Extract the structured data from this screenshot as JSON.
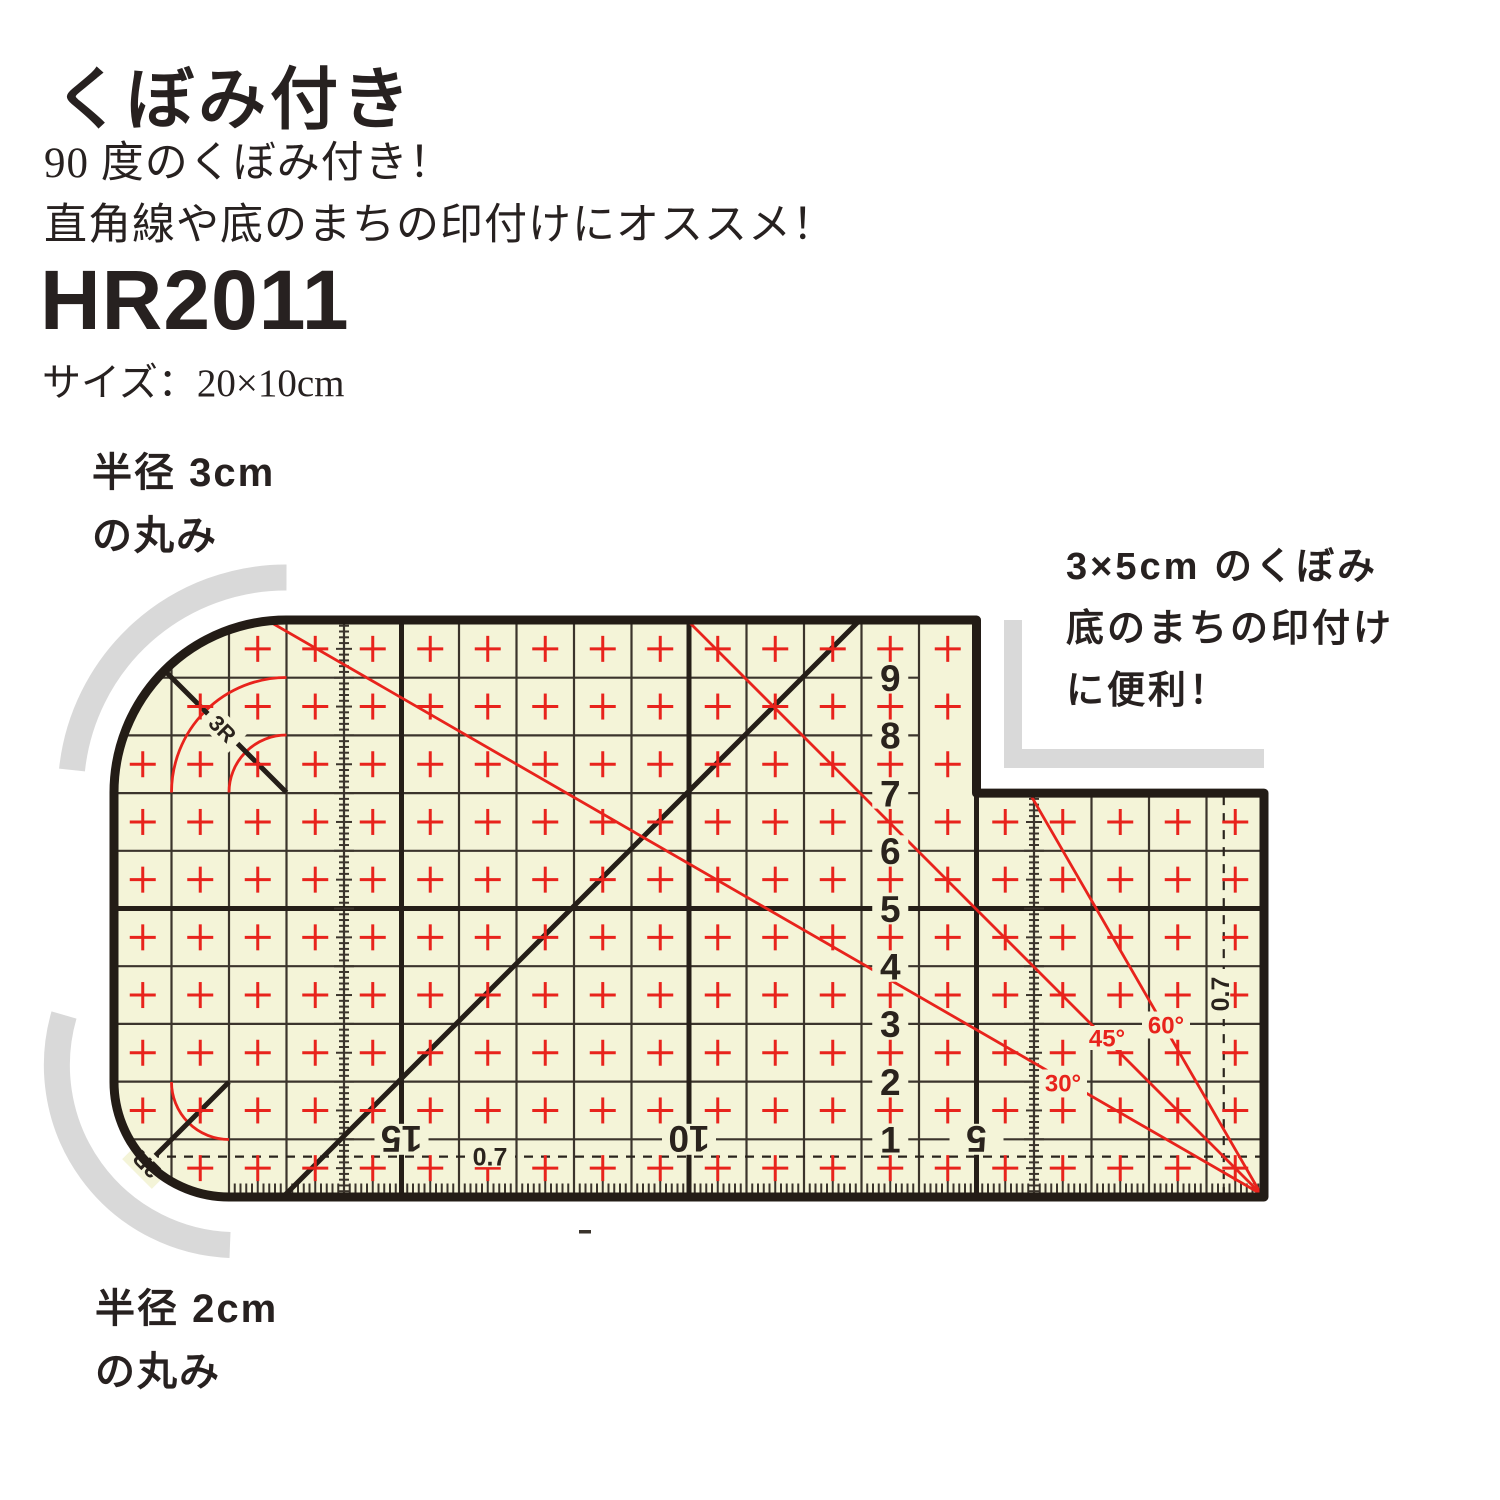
{
  "header": {
    "title": "くぼみ付き",
    "subtitle1": "90 度のくぼみ付き！",
    "subtitle2": "直角線や底のまちの印付けにオススメ！",
    "model": "HR2011",
    "size_label": "サイズ：20×10cm"
  },
  "callouts": {
    "top_left_line1": "半径 3cm",
    "top_left_line2": "の丸み",
    "bottom_left_line1": "半径 2cm",
    "bottom_left_line2": "の丸み",
    "right_line1": "3×5cm のくぼみ",
    "right_line2": "底のまちの印付け",
    "right_line3": "に便利！"
  },
  "ruler": {
    "width_cm": 20,
    "height_cm": 10,
    "notch": {
      "width_cm": 5,
      "depth_cm": 3
    },
    "corner_radius_top_left_cm": 3,
    "corner_radius_bottom_left_cm": 2,
    "side_numbers": [
      "9",
      "8",
      "7",
      "6",
      "5",
      "4",
      "3",
      "2",
      "1"
    ],
    "bottom_numbers": [
      "15",
      "10",
      "5"
    ],
    "angle_labels": [
      "30°",
      "45°",
      "60°"
    ],
    "offset_label_bottom": "0.7",
    "offset_label_right": "0.7",
    "radius_label_top_left": "3R",
    "radius_label_bottom_left": "2R",
    "colors": {
      "fill": "#f4f4d8",
      "grid": "#3b342c",
      "heavy": "#251e18",
      "red": "#e8231c",
      "gray": "#d9d9d9",
      "label": "#2a231d"
    }
  }
}
